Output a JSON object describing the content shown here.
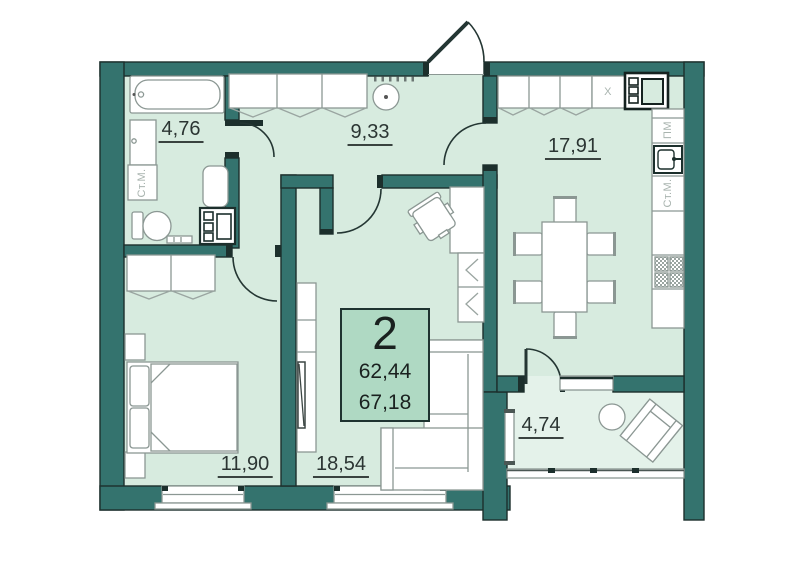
{
  "floorplan": {
    "summary": {
      "rooms_count": "2",
      "area_living": "62,44",
      "area_total": "67,18"
    },
    "room_areas": {
      "bathroom": "4,76",
      "hallway": "9,33",
      "kitchen": "17,91",
      "bedroom": "11,90",
      "living_room": "18,54",
      "balcony": "4,74"
    },
    "appliance_labels": {
      "bathroom_washer": "Ст.М.",
      "dishwasher": "ПМ",
      "kitchen_washer": "Ст.М.",
      "fridge": "X"
    },
    "colors": {
      "wall": "#34736e",
      "room_fill": "#d7ebdf",
      "balcony_fill": "#e4f2ea",
      "info_box_fill": "#afd9c3",
      "furniture_outline": "#8b9793",
      "text_dark": "#2b3533",
      "label_gray": "#a9b4af"
    }
  }
}
